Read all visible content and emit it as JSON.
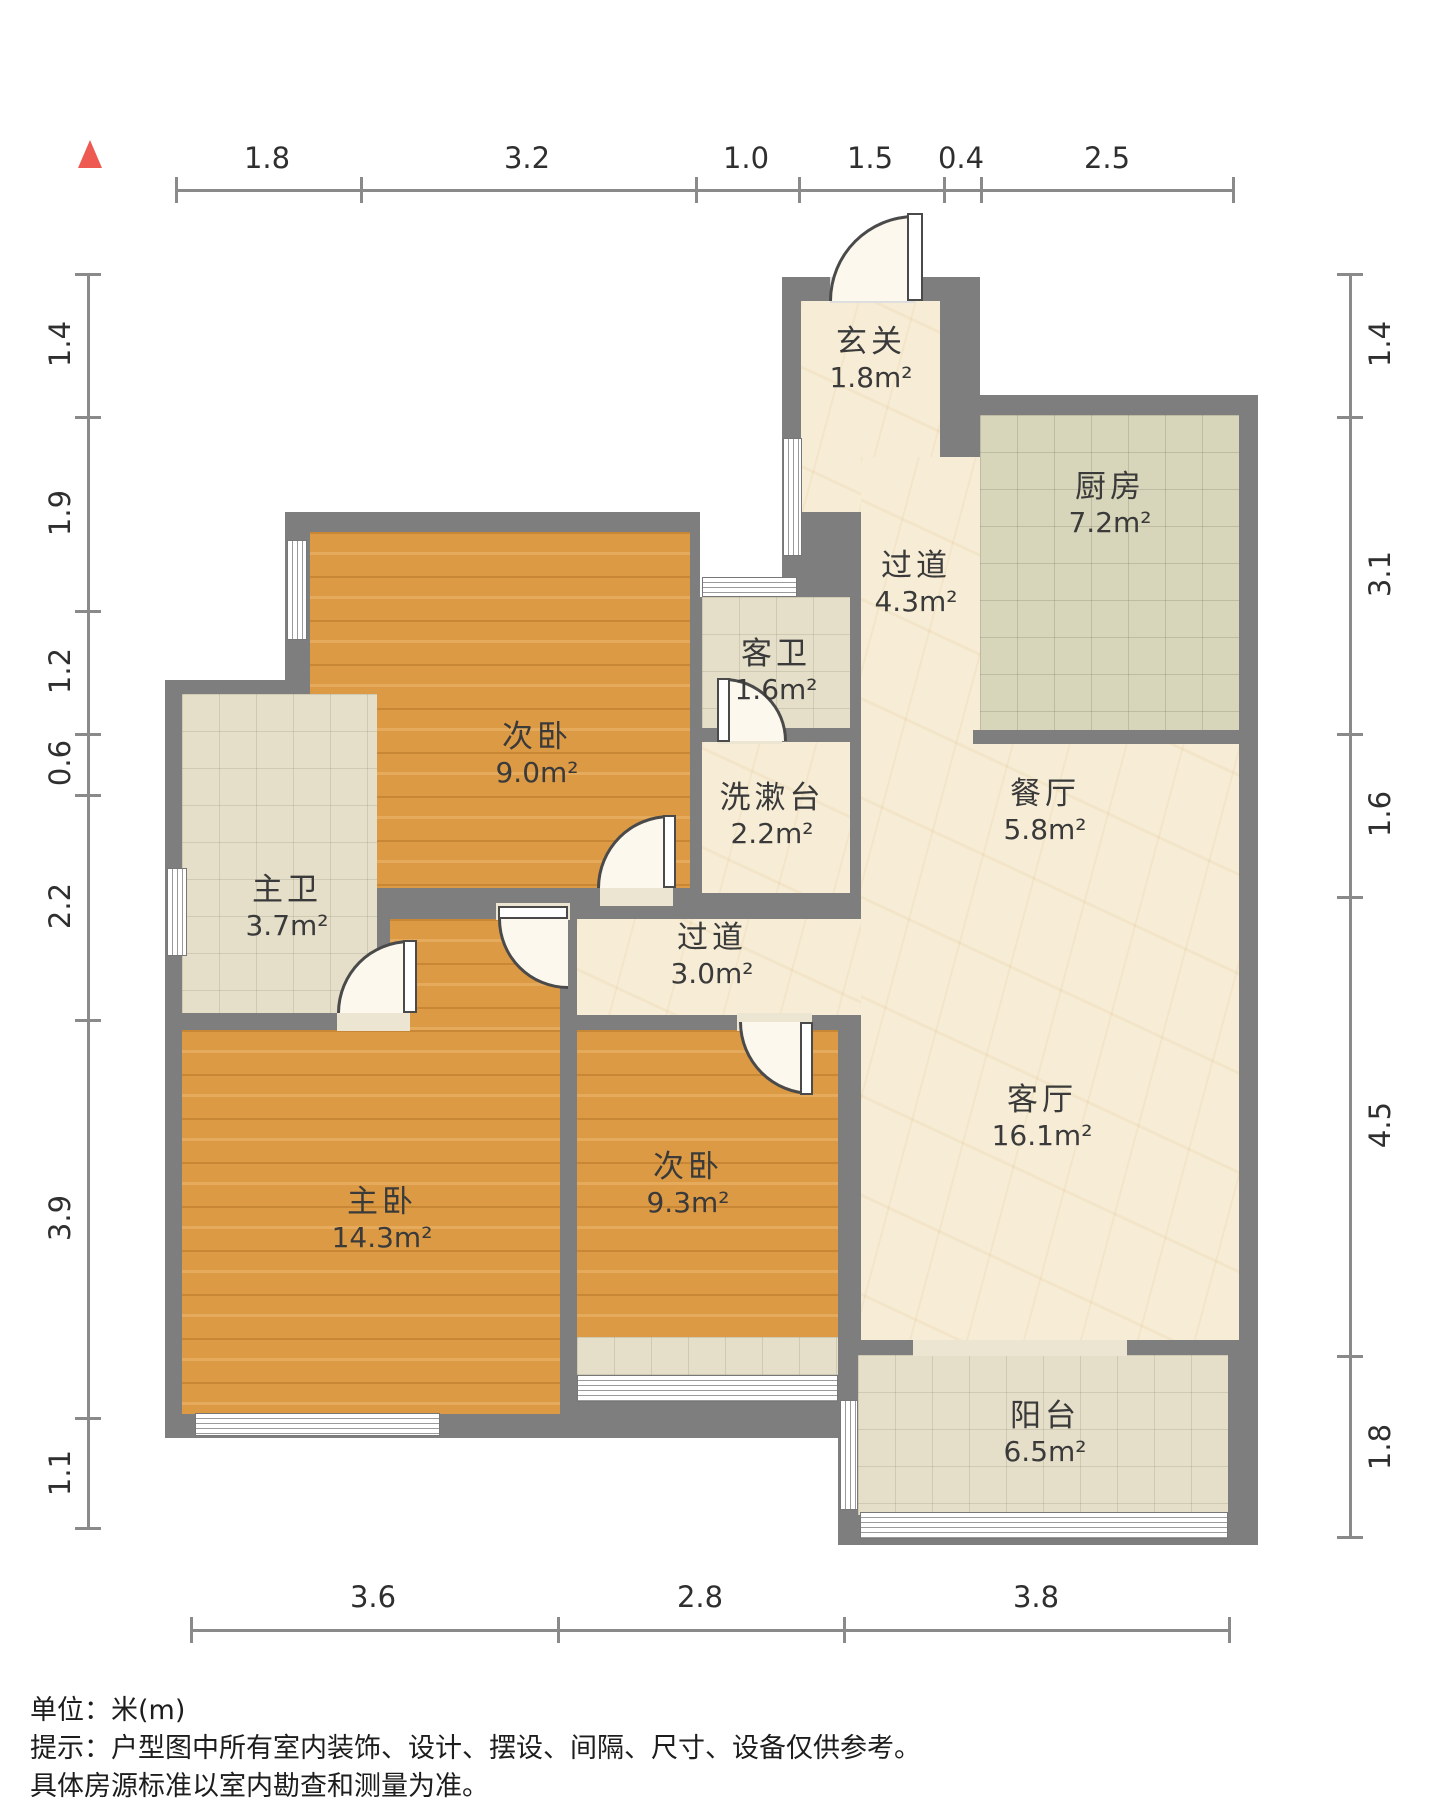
{
  "meta": {
    "type": "residential-floor-plan",
    "colors": {
      "wall": "#7e7e7e",
      "wood_floor": "#dc9a45",
      "marble_floor": "#f7edd6",
      "kitchen_tile": "#d8d6ba",
      "bath_tile": "#e5dfc9",
      "north_arrow": "#ee5a52"
    },
    "icons": {
      "north_arrow": "red-triangle-up"
    }
  },
  "rooms": [
    {
      "id": "xuanguan",
      "name": "玄关",
      "area": "1.8m²"
    },
    {
      "id": "guodao-n",
      "name": "过道",
      "area": "4.3m²"
    },
    {
      "id": "chufang",
      "name": "厨房",
      "area": "7.2m²"
    },
    {
      "id": "kewei",
      "name": "客卫",
      "area": "1.6m²"
    },
    {
      "id": "ciwo-n",
      "name": "次卧",
      "area": "9.0m²"
    },
    {
      "id": "xishutai",
      "name": "洗漱台",
      "area": "2.2m²"
    },
    {
      "id": "canting",
      "name": "餐厅",
      "area": "5.8m²"
    },
    {
      "id": "zhuwei",
      "name": "主卫",
      "area": "3.7m²"
    },
    {
      "id": "guodao-m",
      "name": "过道",
      "area": "3.0m²"
    },
    {
      "id": "zhuwo",
      "name": "主卧",
      "area": "14.3m²"
    },
    {
      "id": "ciwo-s",
      "name": "次卧",
      "area": "9.3m²"
    },
    {
      "id": "keting",
      "name": "客厅",
      "area": "16.1m²"
    },
    {
      "id": "yangtai",
      "name": "阳台",
      "area": "6.5m²"
    }
  ],
  "rulers": {
    "top": [
      "1.8",
      "3.2",
      "1.0",
      "1.5",
      "0.4",
      "2.5"
    ],
    "left": [
      "1.4",
      "1.9",
      "1.2",
      "0.6",
      "2.2",
      "3.9",
      "1.1"
    ],
    "right": [
      "1.4",
      "3.1",
      "1.6",
      "4.5",
      "1.8"
    ],
    "bottom": [
      "3.6",
      "2.8",
      "3.8"
    ]
  },
  "footer": {
    "line1": "单位：米(m)",
    "line2": "提示：户型图中所有室内装饰、设计、摆设、间隔、尺寸、设备仅供参考。",
    "line3": "具体房源标准以室内勘查和测量为准。"
  }
}
